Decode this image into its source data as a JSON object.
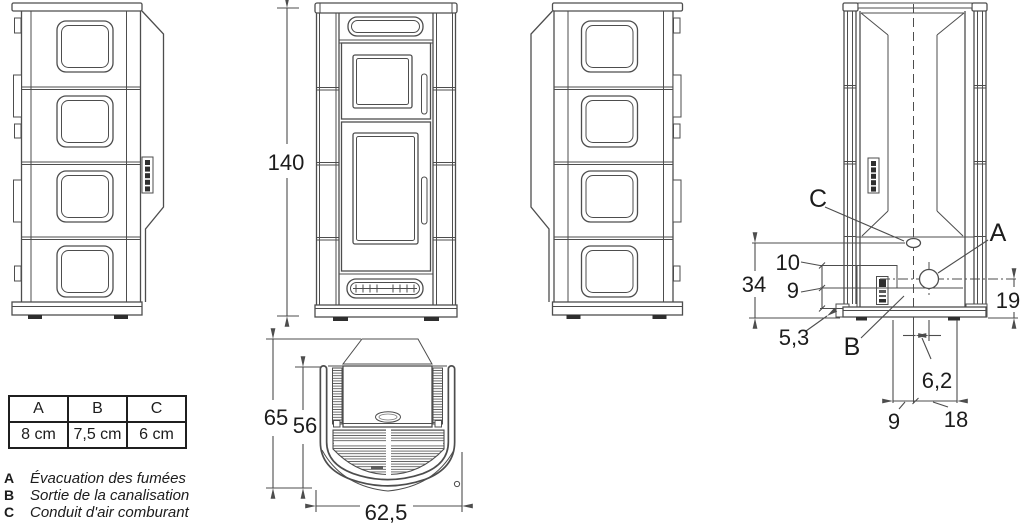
{
  "drawing": {
    "front": {
      "height": "140"
    },
    "rear": {
      "label_a": "A",
      "label_b": "B",
      "label_c": "C",
      "dim_34": "34",
      "dim_10": "10",
      "dim_9_side": "9",
      "dim_5_3": "5,3",
      "dim_19": "19",
      "dim_6_2": "6,2",
      "dim_9_bottom": "9",
      "dim_18": "18"
    },
    "top": {
      "dim_65": "65",
      "dim_56": "56",
      "dim_62_5": "62,5"
    }
  },
  "table": {
    "headers": [
      "A",
      "B",
      "C"
    ],
    "values": [
      "8 cm",
      "7,5 cm",
      "6 cm"
    ]
  },
  "legend": [
    {
      "key": "A",
      "text": "Évacuation des fumées"
    },
    {
      "key": "B",
      "text": "Sortie de la canalisation"
    },
    {
      "key": "C",
      "text": "Conduit d'air comburant"
    }
  ],
  "colors": {
    "line": "#4d4d4d",
    "text": "#1c1c1c",
    "background": "#ffffff"
  }
}
